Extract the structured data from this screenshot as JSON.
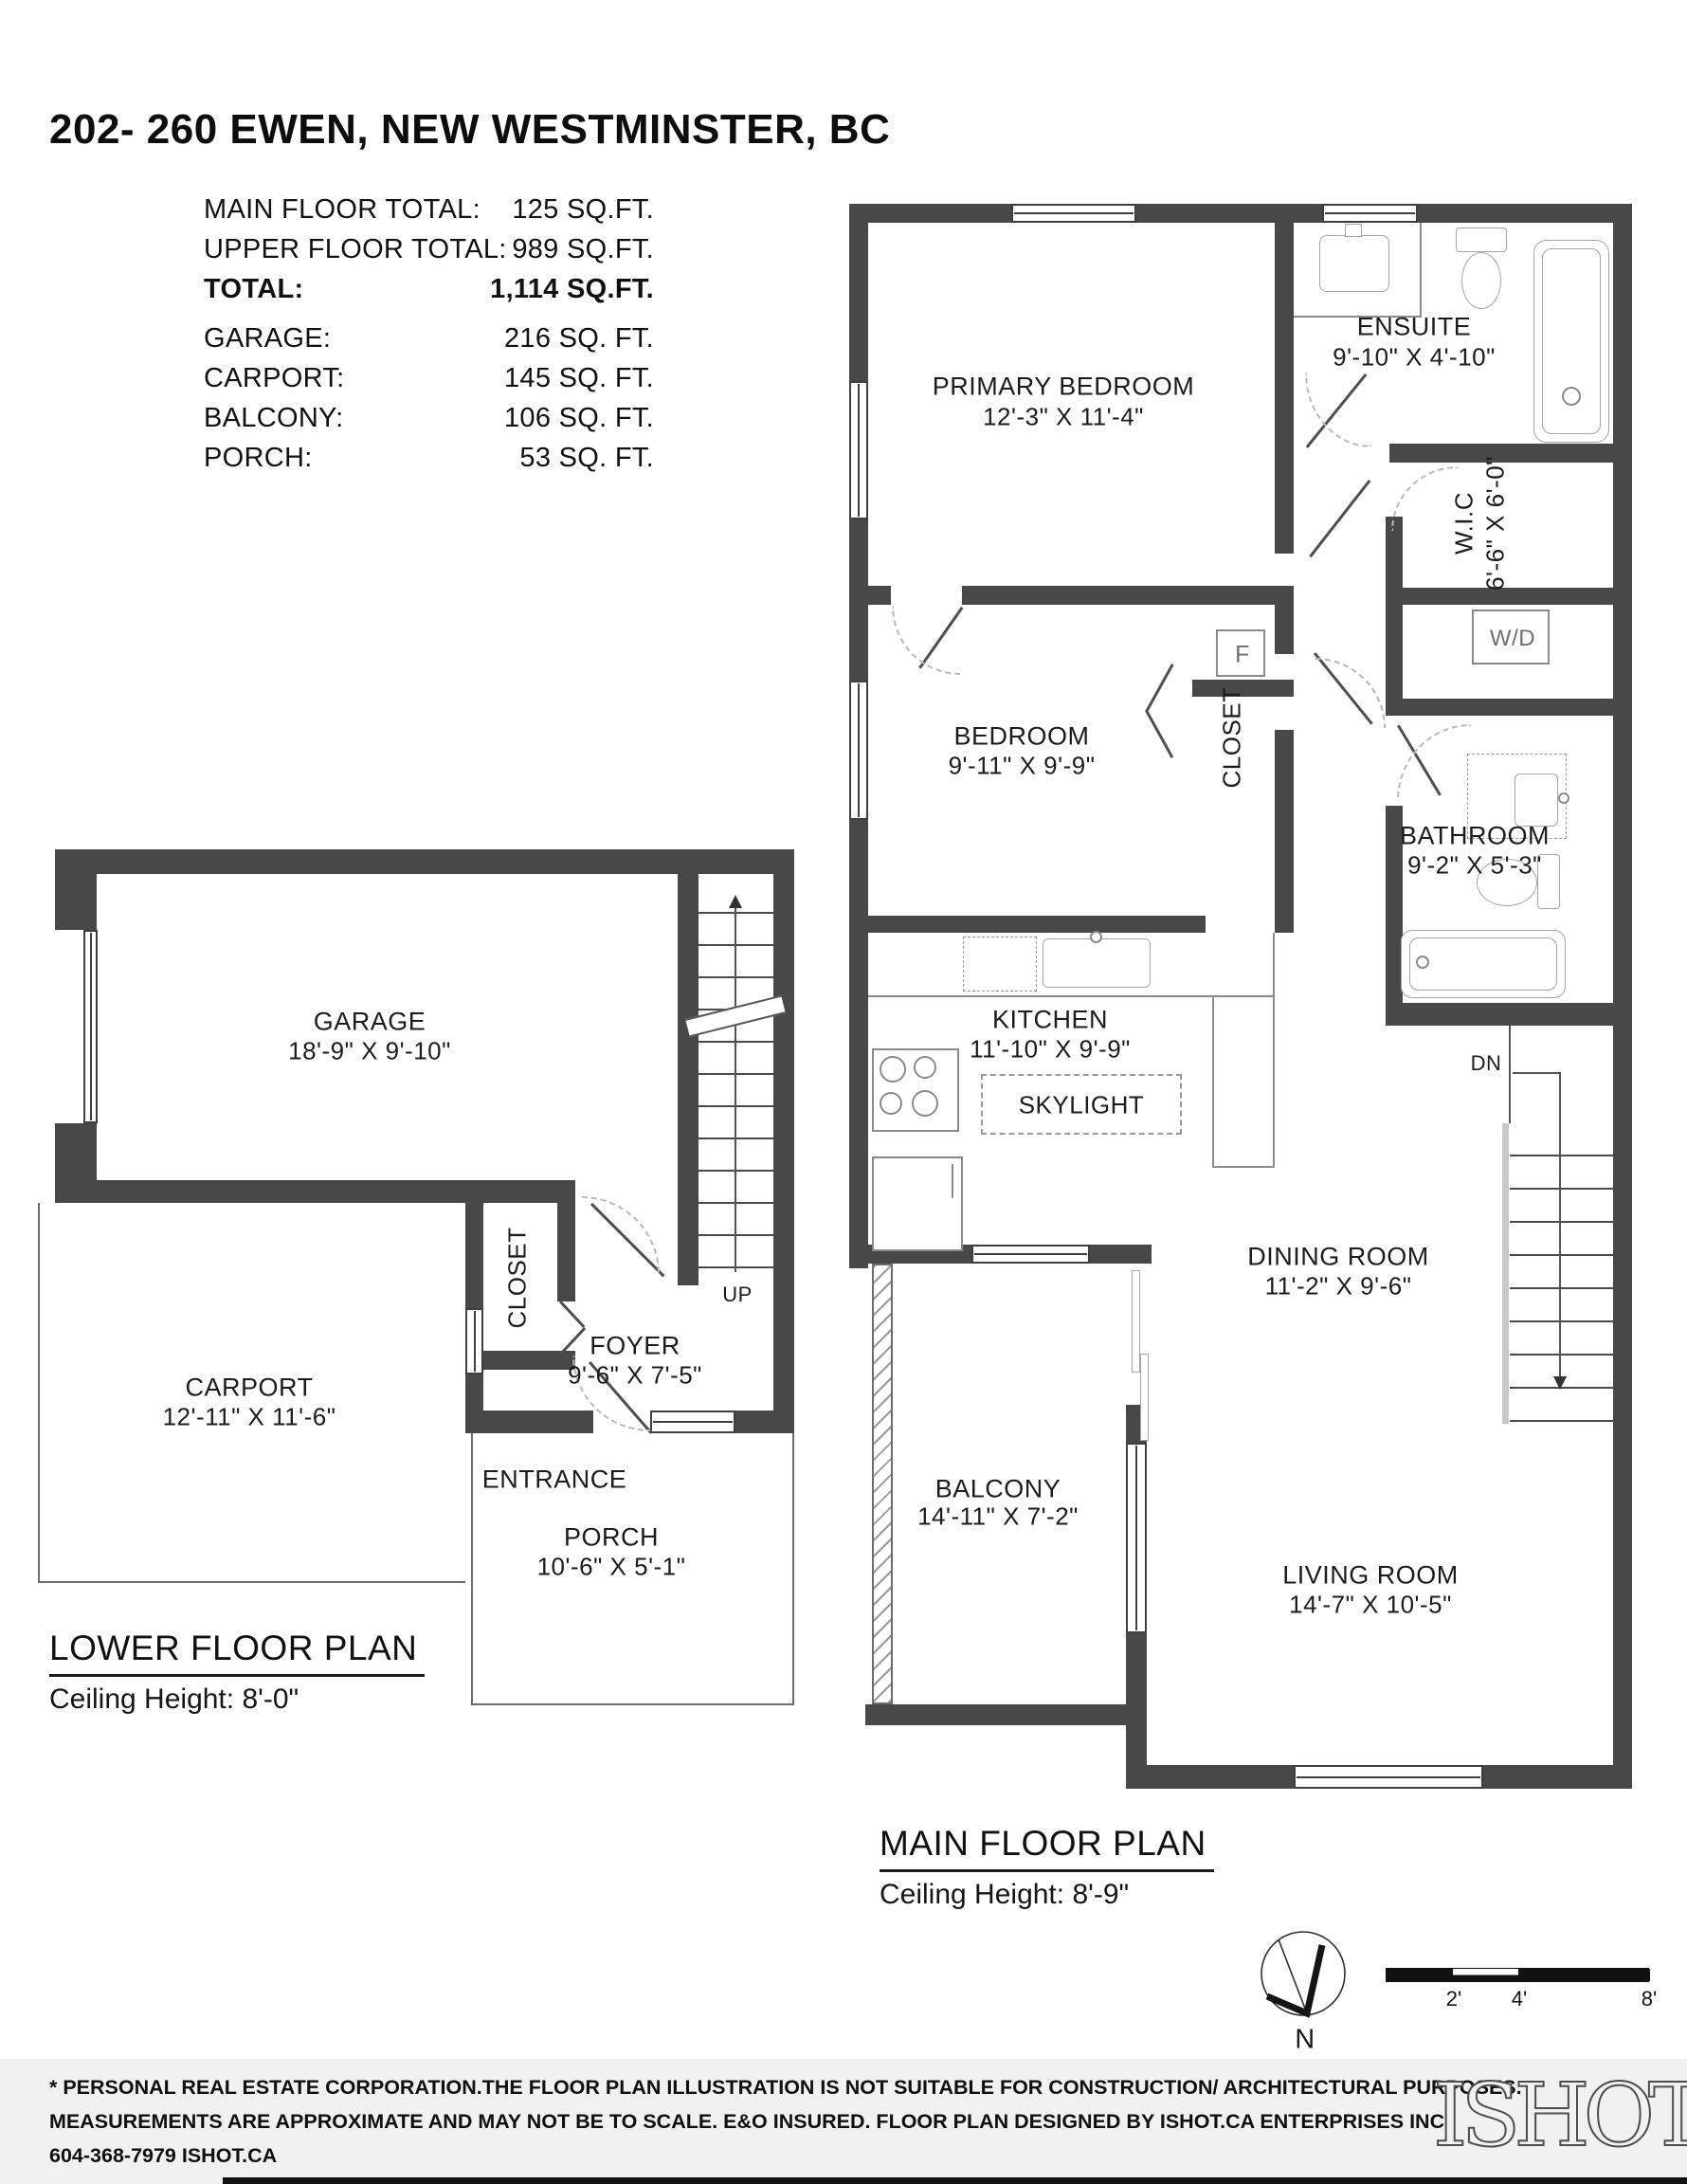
{
  "colors": {
    "wall": "#484848",
    "footer_bg": "#f1f1f1",
    "text": "#1c1c1c"
  },
  "header": {
    "title": "202- 260 EWEN, NEW WESTMINSTER, BC",
    "summary": [
      {
        "label": "MAIN FLOOR TOTAL:",
        "value": "125 SQ.FT."
      },
      {
        "label": "UPPER FLOOR TOTAL:",
        "value": "989 SQ.FT."
      },
      {
        "label": "TOTAL:",
        "value": "1,114 SQ.FT."
      },
      {
        "label": "GARAGE:",
        "value": "216 SQ. FT."
      },
      {
        "label": "CARPORT:",
        "value": "145 SQ. FT."
      },
      {
        "label": "BALCONY:",
        "value": "106 SQ. FT."
      },
      {
        "label": "PORCH:",
        "value": "53 SQ. FT."
      }
    ]
  },
  "lower_plan": {
    "title": "LOWER FLOOR PLAN",
    "ceiling": "Ceiling Height: 8'-0\"",
    "rooms": {
      "garage": {
        "name": "GARAGE",
        "dims": "18'-9\" X 9'-10\""
      },
      "carport": {
        "name": "CARPORT",
        "dims": "12'-11\" X 11'-6\""
      },
      "foyer": {
        "name": "FOYER",
        "dims": "9'-6\" X 7'-5\""
      },
      "porch": {
        "name": "PORCH",
        "dims": "10'-6\" X 5'-1\""
      },
      "closet": {
        "name": "CLOSET"
      },
      "entrance": {
        "name": "ENTRANCE"
      },
      "up": "UP"
    }
  },
  "main_plan": {
    "title": "MAIN FLOOR PLAN",
    "ceiling": "Ceiling Height: 8'-9\"",
    "rooms": {
      "primary_bedroom": {
        "name": "PRIMARY BEDROOM",
        "dims": "12'-3\" X 11'-4\""
      },
      "ensuite": {
        "name": "ENSUITE",
        "dims": "9'-10\" X 4'-10\""
      },
      "wic": {
        "name": "W.I.C",
        "dims": "6'-6\" X 6'-0\""
      },
      "bedroom": {
        "name": "BEDROOM",
        "dims": "9'-11\" X 9'-9\""
      },
      "closet": {
        "name": "CLOSET"
      },
      "bathroom": {
        "name": "BATHROOM",
        "dims": "9'-2\" X 5'-3\""
      },
      "kitchen": {
        "name": "KITCHEN",
        "dims": "11'-10\" X 9'-9\""
      },
      "skylight": {
        "name": "SKYLIGHT"
      },
      "dining": {
        "name": "DINING ROOM",
        "dims": "11'-2\" X 9'-6\""
      },
      "balcony": {
        "name": "BALCONY",
        "dims": "14'-11\" X 7'-2\""
      },
      "living": {
        "name": "LIVING ROOM",
        "dims": "14'-7\" X 10'-5\""
      },
      "washer_dryer": "W/D",
      "furnace": "F",
      "down": "DN"
    }
  },
  "compass": {
    "north": "N"
  },
  "scale_bar": {
    "labels": [
      "2'",
      "4'",
      "8'"
    ]
  },
  "footer": {
    "line1": "* PERSONAL REAL ESTATE CORPORATION.THE FLOOR PLAN ILLUSTRATION IS NOT SUITABLE FOR CONSTRUCTION/ ARCHITECTURAL PURPOSES.",
    "line2": "MEASUREMENTS ARE APPROXIMATE AND MAY NOT BE TO SCALE. E&O INSURED. FLOOR PLAN DESIGNED BY ISHOT.CA ENTERPRISES INC.",
    "line3": "604-368-7979  ISHOT.CA",
    "logo": "ISHOT"
  }
}
